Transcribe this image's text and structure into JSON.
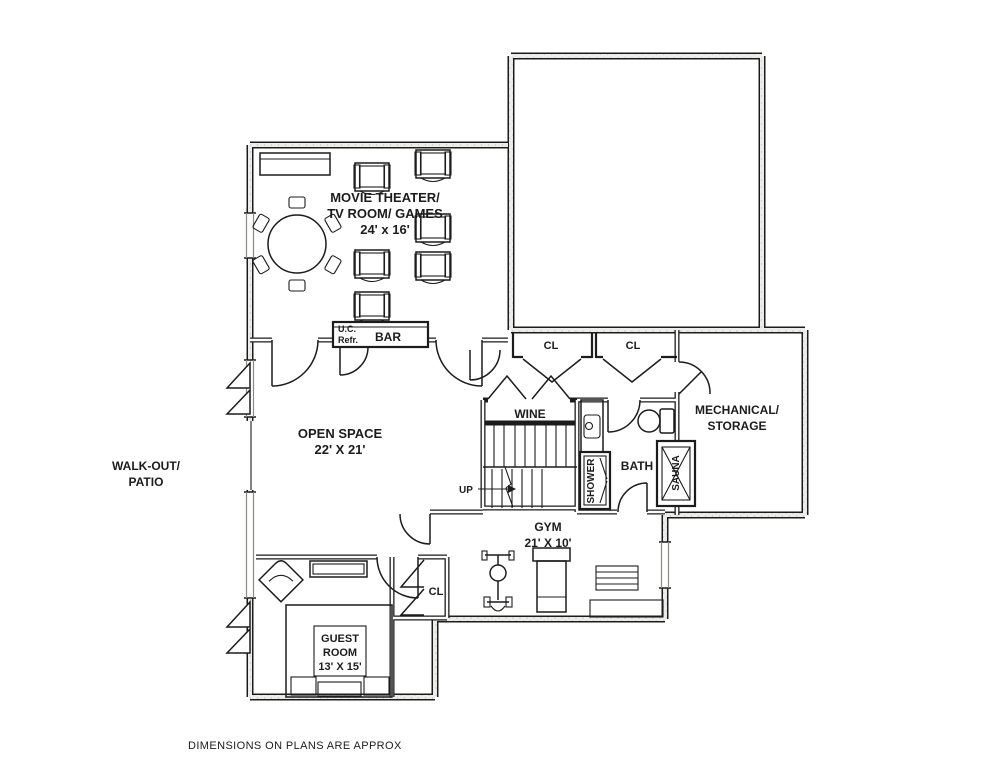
{
  "labels": {
    "movie_theater_1": "MOVIE THEATER/",
    "movie_theater_2": "TV ROOM/ GAMES",
    "movie_theater_dims": "24' x 16'",
    "open_space": "OPEN SPACE",
    "open_space_dims": "22' X 21'",
    "walk_out_1": "WALK-OUT/",
    "walk_out_2": "PATIO",
    "wine": "WINE",
    "bar": "BAR",
    "uc_refr_1": "U.C.",
    "uc_refr_2": "Refr.",
    "closet_hall_1": "CL",
    "closet_hall_2": "CL",
    "closet_gym": "CL",
    "bath": "BATH",
    "shower": "SHOWER",
    "sauna": "SAUNA",
    "mechanical_1": "MECHANICAL/",
    "mechanical_2": "STORAGE",
    "gym": "GYM",
    "gym_dims": "21' X 10'",
    "guest_1": "GUEST",
    "guest_2": "ROOM",
    "guest_dims": "13' X 15'",
    "up": "UP",
    "footer": "DIMENSIONS ON PLANS ARE APPROX"
  },
  "colors": {
    "line": "#1c1c1c",
    "wall_fill": "#ececea",
    "wall_dot": "#c8c8c4",
    "paper": "#ffffff"
  }
}
